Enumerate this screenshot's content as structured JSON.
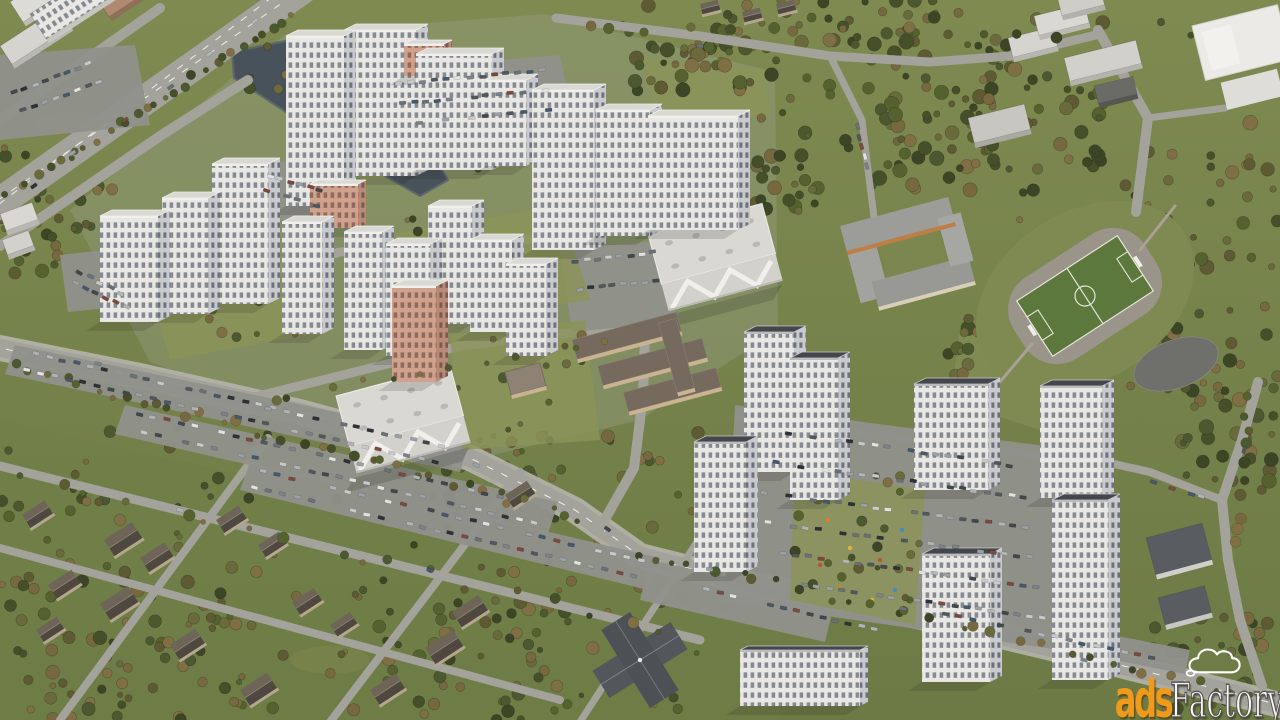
{
  "watermark": {
    "brand_prefix": "ads",
    "brand_suffix": "Factory",
    "icon": "cloud",
    "prefix_color": "#f09a1c",
    "suffix_color": "#f7f7f5",
    "outline_color": "#55514c",
    "cloud_color": "#ffffff"
  },
  "scene": {
    "type": "3d-aerial-render",
    "elements": [
      "residential-towers",
      "retail-centers",
      "schools",
      "kindergarten",
      "parking-lots",
      "highway",
      "pond",
      "forest",
      "soccer-field",
      "paved-court",
      "suburban-houses",
      "roads",
      "warehouse"
    ]
  },
  "palette": {
    "grass": "#76834a",
    "grass_dark": "#6f7e47",
    "grass_light": "#8b9458",
    "urban_wash": "#99a089",
    "water": "#47525a",
    "water_edge": "#5d686e",
    "road": "#a3a29b",
    "asphalt": "#90918b",
    "sidewalk": "#b6b4ac",
    "lane_line": "#e9e9e3",
    "facade_lit": "#e8e7e3",
    "facade_shade": "#c8c9cc",
    "window": "#858a92",
    "window_shade": "#6d727a",
    "salmon": "#d0a18c",
    "salmon_shade": "#b88a78",
    "salmon_window": "#8d6a5c",
    "roof_light": "#d9d8d2",
    "roof_dark": "#43464a",
    "retail_roof": "#dad8d2",
    "school_wall": "#c9b391",
    "school_roof": "#756a5d",
    "house_roof_a": "#6e6558",
    "house_roof_b": "#4f4840",
    "church_roof": "#53565a",
    "pitch": "#5d783c",
    "track": "#9a948a",
    "pitch_line": "#e3e6da",
    "tree_palette": [
      "#4c5830",
      "#55622f",
      "#45502a",
      "#6a6a3c",
      "#77683f",
      "#3c4626",
      "#5e5a33",
      "#806f44"
    ],
    "car_palette": [
      "#e2e2e0",
      "#c7c9cb",
      "#9aa0a6",
      "#6a7077",
      "#42474d",
      "#2e3237",
      "#7b8289",
      "#b0b4b6",
      "#51575e",
      "#7a4a3e",
      "#44586e"
    ]
  }
}
